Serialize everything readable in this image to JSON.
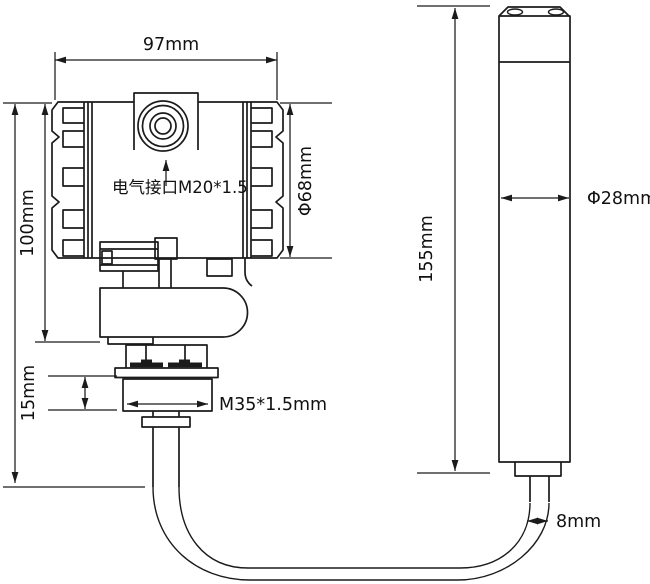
{
  "page": {
    "background": "#ffffff",
    "line_color": "#1b1b1b"
  },
  "diagram": {
    "labels": {
      "body_width": "97mm",
      "body_height": "100mm",
      "body_diameter": "Φ68mm",
      "electrical_port": "电气接口M20*1.5",
      "nut_height": "15mm",
      "thread_spec": "M35*1.5mm",
      "probe_length": "155mm",
      "probe_diameter": "Φ28mm",
      "cable_diameter": "8mm"
    }
  }
}
